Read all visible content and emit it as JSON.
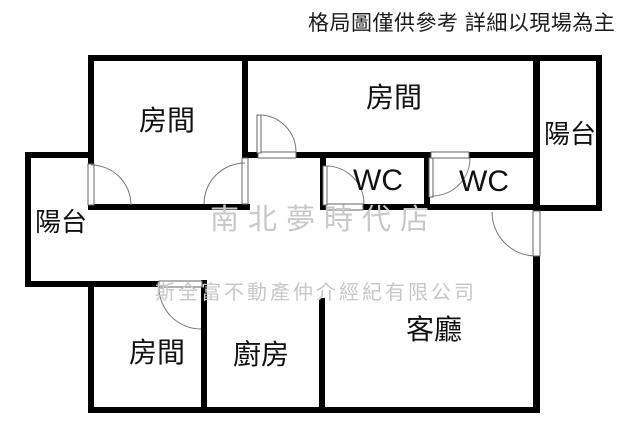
{
  "title": "apartment-floor-plan",
  "disclaimer": {
    "text": "格局圖僅供參考 詳細以現場為主",
    "color": "#1c1c1c"
  },
  "watermarks": {
    "store": {
      "text": "南北夢時代店",
      "color": "#c8c8c8"
    },
    "company": {
      "text": "斯全富不動產仲介經紀有限公司",
      "color": "#c8c8c8"
    }
  },
  "rooms": {
    "bedroom_top_left": {
      "label": "房間"
    },
    "bedroom_top_right": {
      "label": "房間"
    },
    "bedroom_bottom": {
      "label": "房間"
    },
    "balcony_left": {
      "label": "陽台"
    },
    "balcony_right": {
      "label": "陽台"
    },
    "wc_left": {
      "label": "WC"
    },
    "wc_right": {
      "label": "WC"
    },
    "kitchen": {
      "label": "廚房"
    },
    "living_room": {
      "label": "客廳"
    }
  },
  "plan": {
    "wall_color": "#000000",
    "door_line_color": "#777777",
    "background": "#ffffff"
  }
}
